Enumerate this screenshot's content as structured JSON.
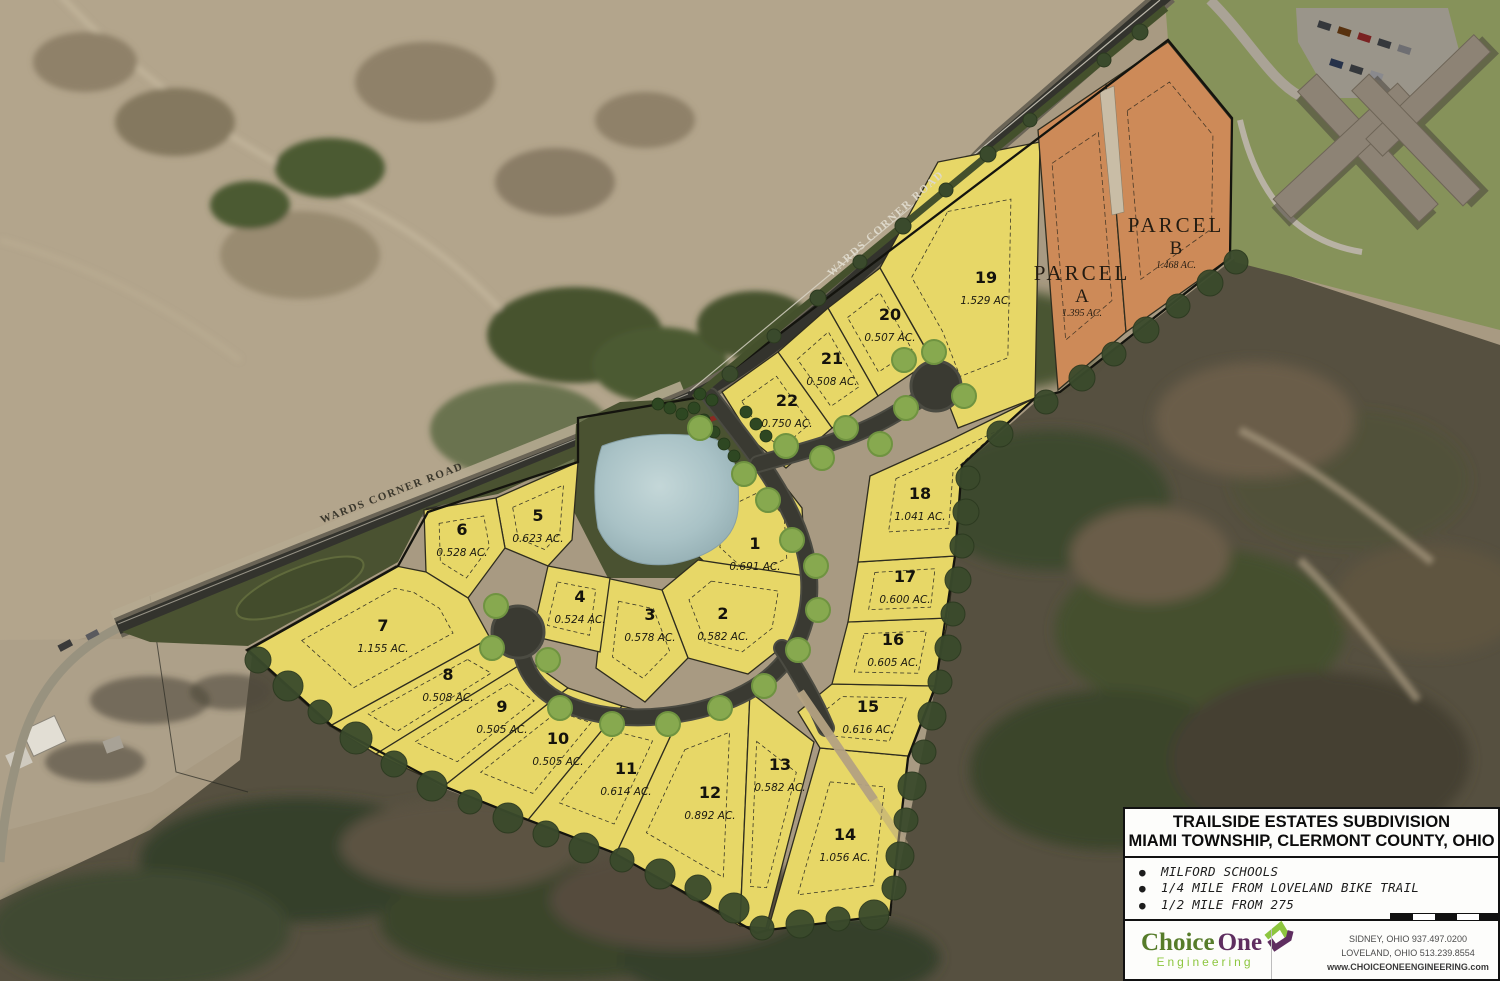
{
  "map": {
    "road_labels": {
      "upper": "WARDS CORNER ROAD",
      "lower": "WARDS CORNER ROAD"
    },
    "lots": [
      {
        "number": "1",
        "acreage": "0.691 AC."
      },
      {
        "number": "2",
        "acreage": "0.582 AC."
      },
      {
        "number": "3",
        "acreage": "0.578 AC."
      },
      {
        "number": "4",
        "acreage": "0.524 AC."
      },
      {
        "number": "5",
        "acreage": "0.623 AC."
      },
      {
        "number": "6",
        "acreage": "0.528 AC."
      },
      {
        "number": "7",
        "acreage": "1.155 AC."
      },
      {
        "number": "8",
        "acreage": "0.508 AC."
      },
      {
        "number": "9",
        "acreage": "0.505 AC."
      },
      {
        "number": "10",
        "acreage": "0.505 AC."
      },
      {
        "number": "11",
        "acreage": "0.614 AC."
      },
      {
        "number": "12",
        "acreage": "0.892 AC."
      },
      {
        "number": "13",
        "acreage": "0.582 AC."
      },
      {
        "number": "14",
        "acreage": "1.056 AC."
      },
      {
        "number": "15",
        "acreage": "0.616 AC."
      },
      {
        "number": "16",
        "acreage": "0.605 AC."
      },
      {
        "number": "17",
        "acreage": "0.600 AC."
      },
      {
        "number": "18",
        "acreage": "1.041 AC."
      },
      {
        "number": "19",
        "acreage": "1.529 AC."
      },
      {
        "number": "20",
        "acreage": "0.507 AC."
      },
      {
        "number": "21",
        "acreage": "0.508 AC."
      },
      {
        "number": "22",
        "acreage": "0.750 AC."
      }
    ],
    "parcels": [
      {
        "title": "PARCEL",
        "letter": "A",
        "acreage": "1.395 AC."
      },
      {
        "title": "PARCEL",
        "letter": "B",
        "acreage": "1.468 AC."
      }
    ]
  },
  "title_block": {
    "line1": "TRAILSIDE ESTATES SUBDIVISION",
    "line2": "MIAMI TOWNSHIP, CLERMONT COUNTY, OHIO",
    "bullets": [
      "MILFORD SCHOOLS",
      "1/4 MILE FROM LOVELAND BIKE TRAIL",
      "1/2 MILE FROM 275"
    ]
  },
  "logo": {
    "name_part1": "Choice",
    "name_part2": "One",
    "subtitle": "Engineering"
  },
  "contact": {
    "line1": "SIDNEY, OHIO  937.497.0200",
    "line2": "LOVELAND, OHIO  513.239.8554",
    "website": "www.CHOICEONEENGINEERING.com"
  },
  "colors": {
    "lot_fill": "#e7d767",
    "parcel_fill": "#cd8a58",
    "road_dark": "#3a3a32",
    "road_edge": "#4b4b42",
    "buffer_green": "#4a5231",
    "pond_blue": "#a9c2c6",
    "tree_light": "#87a94f",
    "tree_dark": "#3a4a2c",
    "logo_green_dark": "#567c2a",
    "logo_green_light": "#8dc63f",
    "logo_purple": "#5f2e60"
  }
}
